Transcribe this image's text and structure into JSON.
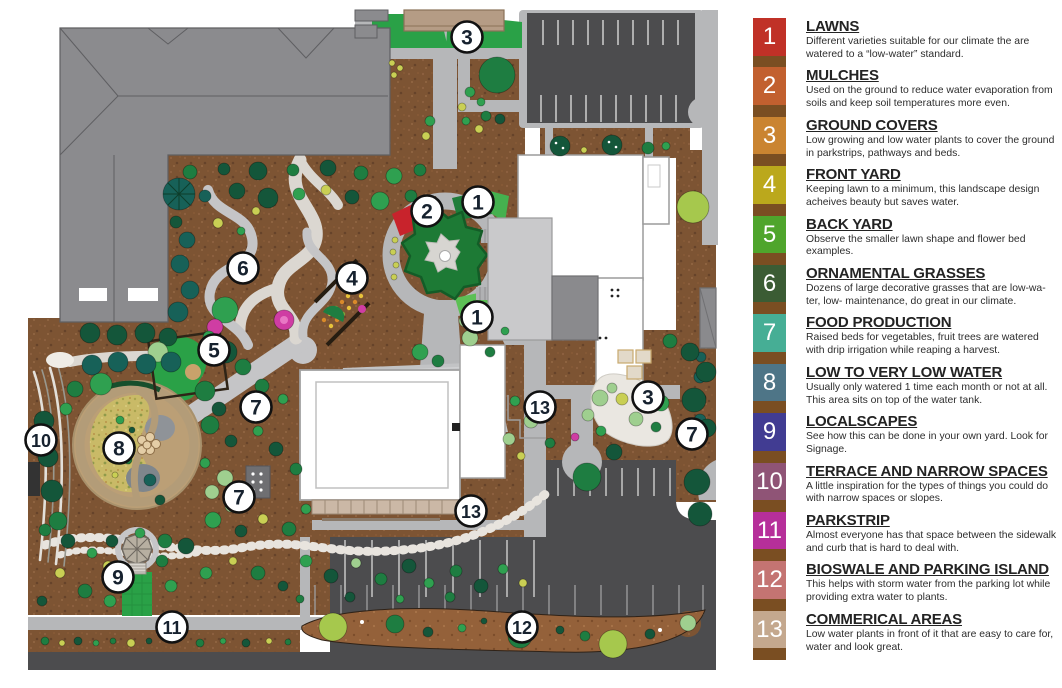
{
  "page": {
    "title": "Water-wise demonstration garden site plan"
  },
  "legend": {
    "separator_color": "#7a4e22",
    "items": [
      {
        "number": "1",
        "title": "LAWNS",
        "color": "#c03127",
        "description": "Different varieties suitable for our climate the are watered to a “low-water” standard."
      },
      {
        "number": "2",
        "title": "MULCHES",
        "color": "#c2602f",
        "description": "Used on the ground to reduce water evaporation from soils and keep soil temperatures more even."
      },
      {
        "number": "3",
        "title": "GROUND COVERS",
        "color": "#ca8431",
        "description": "Low growing and low water plants to cover the ground in parkstrips, pathways and beds."
      },
      {
        "number": "4",
        "title": "FRONT YARD",
        "color": "#bba81c",
        "description": "Keeping lawn to a minimum, this landscape design acheives beauty but saves water."
      },
      {
        "number": "5",
        "title": "BACK YARD",
        "color": "#4fa52c",
        "description": "Observe the smaller lawn shape and flower bed examples."
      },
      {
        "number": "6",
        "title": "ORNAMENTAL GRASSES",
        "color": "#3b5c34",
        "description": "Dozens of large decorative grasses that are low-wa-ter, low- maintenance, do great in our climate."
      },
      {
        "number": "7",
        "title": "FOOD PRODUCTION",
        "color": "#46ae95",
        "description": "Raised beds for vegetables, fruit trees are watered with drip irrigation while reaping a harvest."
      },
      {
        "number": "8",
        "title": "LOW TO VERY LOW WATER",
        "color": "#4e7587",
        "description": "Usually only watered 1 time each month or not at all. This area sits on top of the water tank."
      },
      {
        "number": "9",
        "title": "LOCALSCAPES",
        "color": "#413c92",
        "description": "See how this can be done in your own yard.  Look for Signage."
      },
      {
        "number": "10",
        "title": "TERRACE AND NARROW SPACES",
        "color": "#8f5476",
        "description": "A little inspiration for the types of things you could do with narrow spaces or slopes."
      },
      {
        "number": "11",
        "title": "PARKSTRIP",
        "color": "#b62f9a",
        "description": "Almost everyone has that space between the sidewalk and curb that is hard to deal with."
      },
      {
        "number": "12",
        "title": "BIOSWALE AND PARKING ISLAND",
        "color": "#c47472",
        "description": "This helps with storm water from the parking lot while providing extra water to plants."
      },
      {
        "number": "13",
        "title": "COMMERICAL AREAS",
        "color": "#c4a88e",
        "description": "Low water plants in front of it that are easy to care for, water and look great."
      }
    ]
  },
  "map": {
    "marker_style": {
      "fill": "#ffffff",
      "stroke": "#111111",
      "text_color": "#16212e"
    },
    "markers": [
      {
        "label": "3",
        "x": 467,
        "y": 37
      },
      {
        "label": "1",
        "x": 478,
        "y": 202
      },
      {
        "label": "2",
        "x": 427,
        "y": 211
      },
      {
        "label": "4",
        "x": 352,
        "y": 278
      },
      {
        "label": "6",
        "x": 243,
        "y": 268
      },
      {
        "label": "5",
        "x": 214,
        "y": 350
      },
      {
        "label": "1",
        "x": 477,
        "y": 317
      },
      {
        "label": "7",
        "x": 256,
        "y": 407
      },
      {
        "label": "10",
        "x": 41,
        "y": 440
      },
      {
        "label": "8",
        "x": 119,
        "y": 448
      },
      {
        "label": "7",
        "x": 239,
        "y": 497
      },
      {
        "label": "13",
        "x": 540,
        "y": 407
      },
      {
        "label": "3",
        "x": 648,
        "y": 397
      },
      {
        "label": "7",
        "x": 692,
        "y": 434
      },
      {
        "label": "13",
        "x": 471,
        "y": 511
      },
      {
        "label": "9",
        "x": 118,
        "y": 577
      },
      {
        "label": "11",
        "x": 172,
        "y": 627
      },
      {
        "label": "12",
        "x": 522,
        "y": 627
      }
    ],
    "colors": {
      "mulch": "#7d5433",
      "parking": "#4c4c4e",
      "path_gray": "#b6b7b9",
      "lawn": "#2aa147",
      "building_roof": "#8b8b8e",
      "white_building": "#ffffff",
      "gravel": "#dbd7d1",
      "circle_garden_ring": "#b39c78",
      "meadow_yellow": "#c9ba67",
      "bioswale": "#94613a"
    }
  }
}
